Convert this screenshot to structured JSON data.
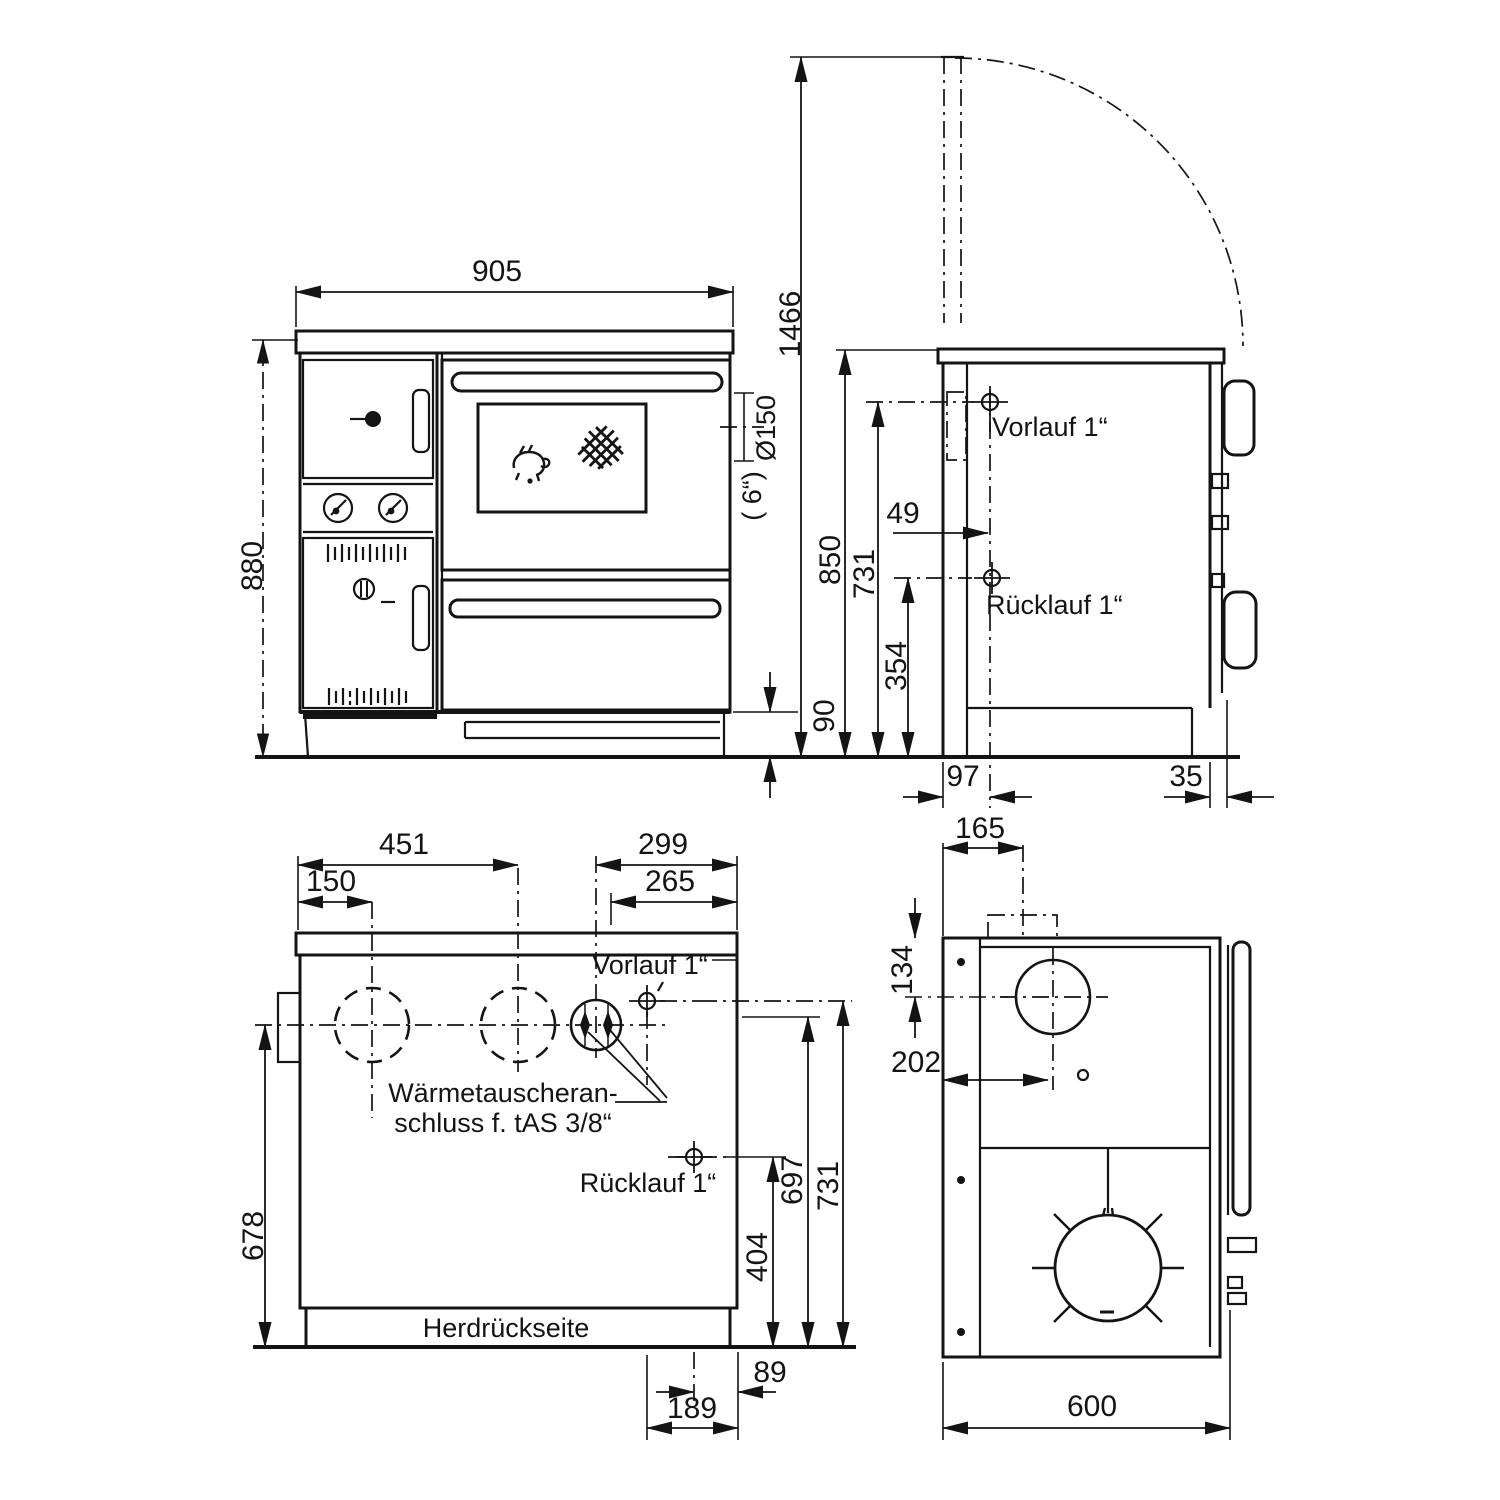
{
  "drawing": {
    "type": "stove-technical-drawing",
    "front": {
      "w": "905",
      "h": "880",
      "flue_h": "1466",
      "flue_d": "Ø150",
      "flue_d2": "( 6“)",
      "plinth": "90"
    },
    "side": {
      "h": "850",
      "vorlauf_h": "731",
      "ruecklauf_h": "354",
      "o49": "49",
      "o97": "97",
      "o35": "35",
      "vorlauf": "Vorlauf 1“",
      "ruecklauf": "Rücklauf 1“"
    },
    "rear": {
      "d451": "451",
      "d150": "150",
      "d299": "299",
      "d265": "265",
      "d678": "678",
      "d404": "404",
      "d697": "697",
      "d731": "731",
      "d89": "89",
      "d189": "189",
      "vorlauf": "Vorlauf 1“",
      "ruecklauf": "Rücklauf 1“",
      "hx1": "Wärmetauscheran-",
      "hx2": "schluss f. tAS 3/8“",
      "back": "Herdrückseite"
    },
    "top": {
      "d165": "165",
      "d134": "134",
      "d202": "202",
      "d600": "600"
    }
  }
}
